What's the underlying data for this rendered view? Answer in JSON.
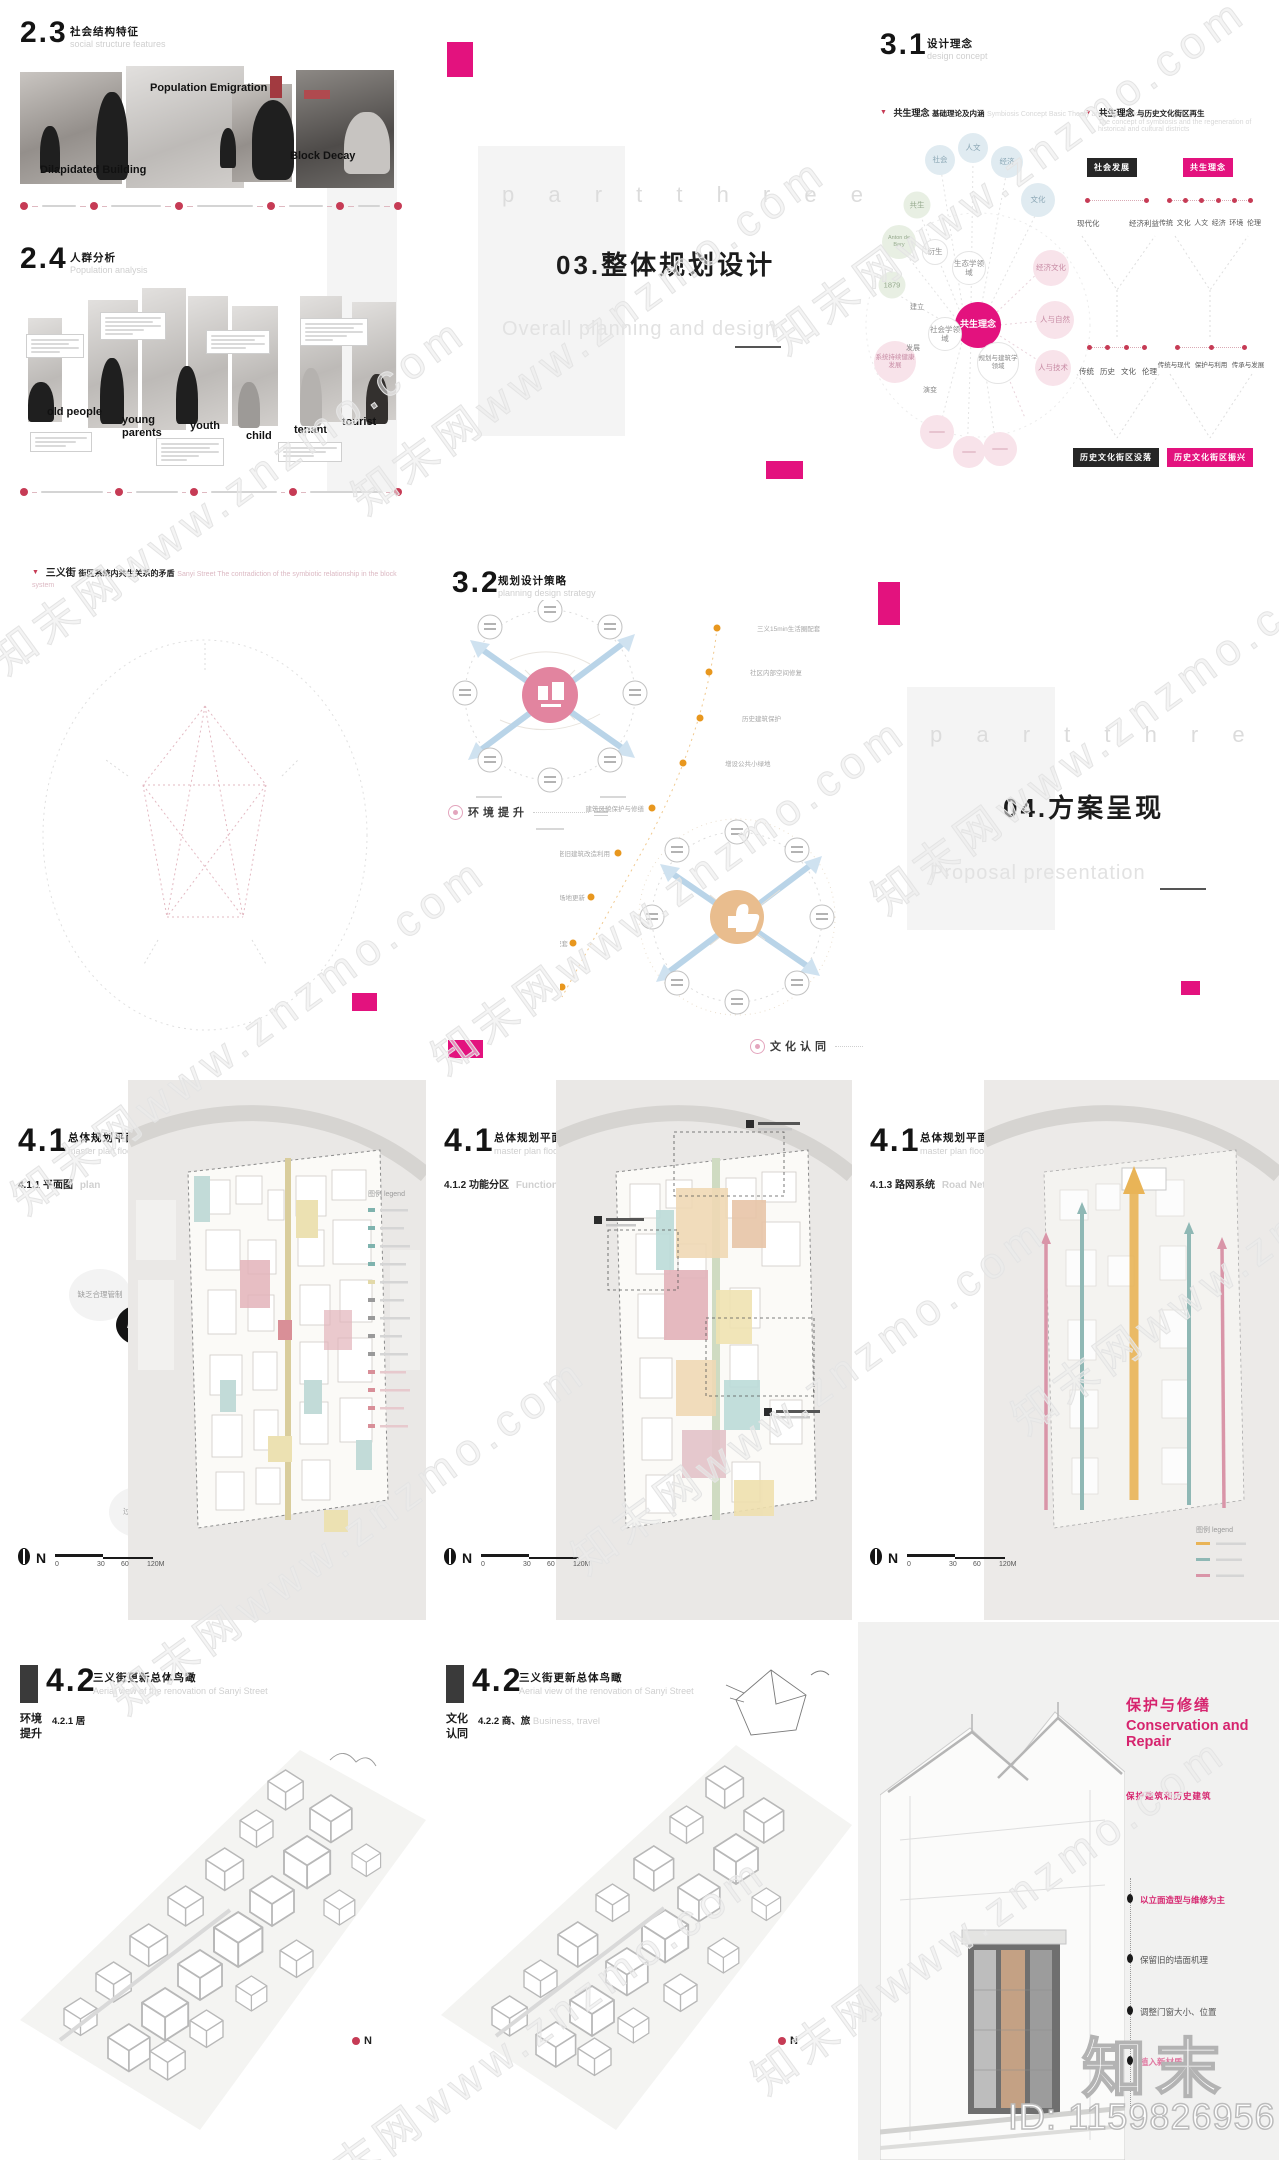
{
  "colors": {
    "accent": "#e3127e",
    "red_dot": "#c63b55",
    "orange": "#e8971e",
    "teal": "#7fb3ae",
    "map_pink": "#d98f98"
  },
  "watermark": {
    "tile": "知末网www.znzmo.com",
    "logo": "知末",
    "id_text": "ID: 1159826956"
  },
  "slide23": {
    "num": "2.3",
    "title": "社会结构特征",
    "subtitle": "social structure features",
    "label_dilapidated": "Dilapidated Building",
    "label_emigration": "Population Emigration",
    "label_decay": "Block Decay"
  },
  "slide24": {
    "num": "2.4",
    "title": "人群分析",
    "subtitle": "Population analysis",
    "persons": [
      "old people",
      "young parents",
      "youth",
      "child",
      "tenant",
      "tourist"
    ]
  },
  "divider03": {
    "part": "p a r t   t h r e e",
    "title": "03.整体规划设计",
    "subtitle": "Overall planning and design"
  },
  "slide31": {
    "num": "3.1",
    "title": "设计理念",
    "subtitle": "design concept",
    "h1": "共生理念",
    "h1b": "基础理论及内涵",
    "h1en": "Symbiosis Concept Basic Theory and Connotation",
    "h2": "共生理念",
    "h2b": "与历史文化街区再生",
    "h2en": "The concept of symbiosis and the regeneration of historical and cultural districts",
    "center": "共生理念",
    "blue": [
      "社会",
      "人文",
      "经济",
      "文化"
    ],
    "green": [
      "共生",
      "Anton de Bary",
      "1879"
    ],
    "pink": [
      "经济文化",
      "人与自然",
      "人与技术",
      "系统持续健康发展"
    ],
    "mid": [
      "衍生",
      "生态学领域",
      "社会学领域",
      "规划与建筑学领域"
    ],
    "small": [
      "建立",
      "发展",
      "演变"
    ],
    "flow1": {
      "top": "社会发展",
      "r1a": "现代化",
      "r1b": "经济利益",
      "r2": [
        "传统",
        "历史",
        "文化",
        "伦理"
      ],
      "bottom": "历史文化街区没落"
    },
    "flow2": {
      "top": "共生理念",
      "r1": [
        "传统",
        "文化",
        "人文",
        "经济",
        "环境",
        "伦理"
      ],
      "r2": [
        "传统与现代",
        "保护与利用",
        "传承与发展"
      ],
      "bottom": "历史文化街区振兴"
    }
  },
  "slideMatrix": {
    "title": "三义街",
    "titleb": "街区系统内共生关系的矛盾",
    "titleen": "Sanyi Street The contradiction of the symbiotic relationship in the block system",
    "nodes": [
      "历史文化",
      "居住环境",
      "商业模式",
      "社会结构",
      "场地限制"
    ],
    "outer": [
      "缺乏保护与传承",
      "缺乏合理管制",
      "过于单一",
      "过于单一",
      "场地内部局限"
    ],
    "lab_outside": "外部矛盾",
    "lab_main": "主要矛盾",
    "lab_inside": "内部矛盾"
  },
  "slide32": {
    "num": "3.2",
    "title": "规划设计策略",
    "subtitle": "planning design strategy",
    "tag1": "环境提升",
    "tag2": "文化认同",
    "right_labels": [
      "三义15min生活圈配套",
      "社区内部空间修复",
      "历史建筑保护",
      "增设公共小绿地"
    ],
    "left_labels": [
      "建筑风貌保护与修缮",
      "老旧建筑改造利用",
      "社区活动场地更新",
      "完善基础设施配套"
    ]
  },
  "divider04": {
    "part": "p a r t   t h r e e",
    "title": "04.方案呈现",
    "subtitle": "Proposal presentation"
  },
  "slide41": {
    "num": "4.1",
    "title": "总体规划平面图",
    "subtitle": "master plan floor plan",
    "s1": "4.1.1 平面图",
    "s1en": "plan",
    "s2": "4.1.2 功能分区",
    "s2en": "Functional Division",
    "s3": "4.1.3 路网系统",
    "s3en": "Road Network",
    "legend": "图例 legend",
    "compass": "N",
    "scale": [
      "0",
      "30",
      "60",
      "120M"
    ]
  },
  "slide42": {
    "num": "4.2",
    "title": "三义街更新总体鸟瞰",
    "subtitle": "Aerial view of the renovation of Sanyi Street",
    "tag_a": "环境提升",
    "sub_a": "4.2.1 居",
    "tag_b": "文化认同",
    "sub_b": "4.2.2 商、旅",
    "en_b": "Business, travel",
    "compass": "N"
  },
  "slideRepair": {
    "title": "保护与修缮",
    "title_en": "Conservation and Repair",
    "subtitle": "保护建筑和历史建筑",
    "bullets": [
      "以立面造型与维修为主",
      "保留旧的墙面机理",
      "调整门窗大小、位置",
      "植入新材质"
    ]
  }
}
